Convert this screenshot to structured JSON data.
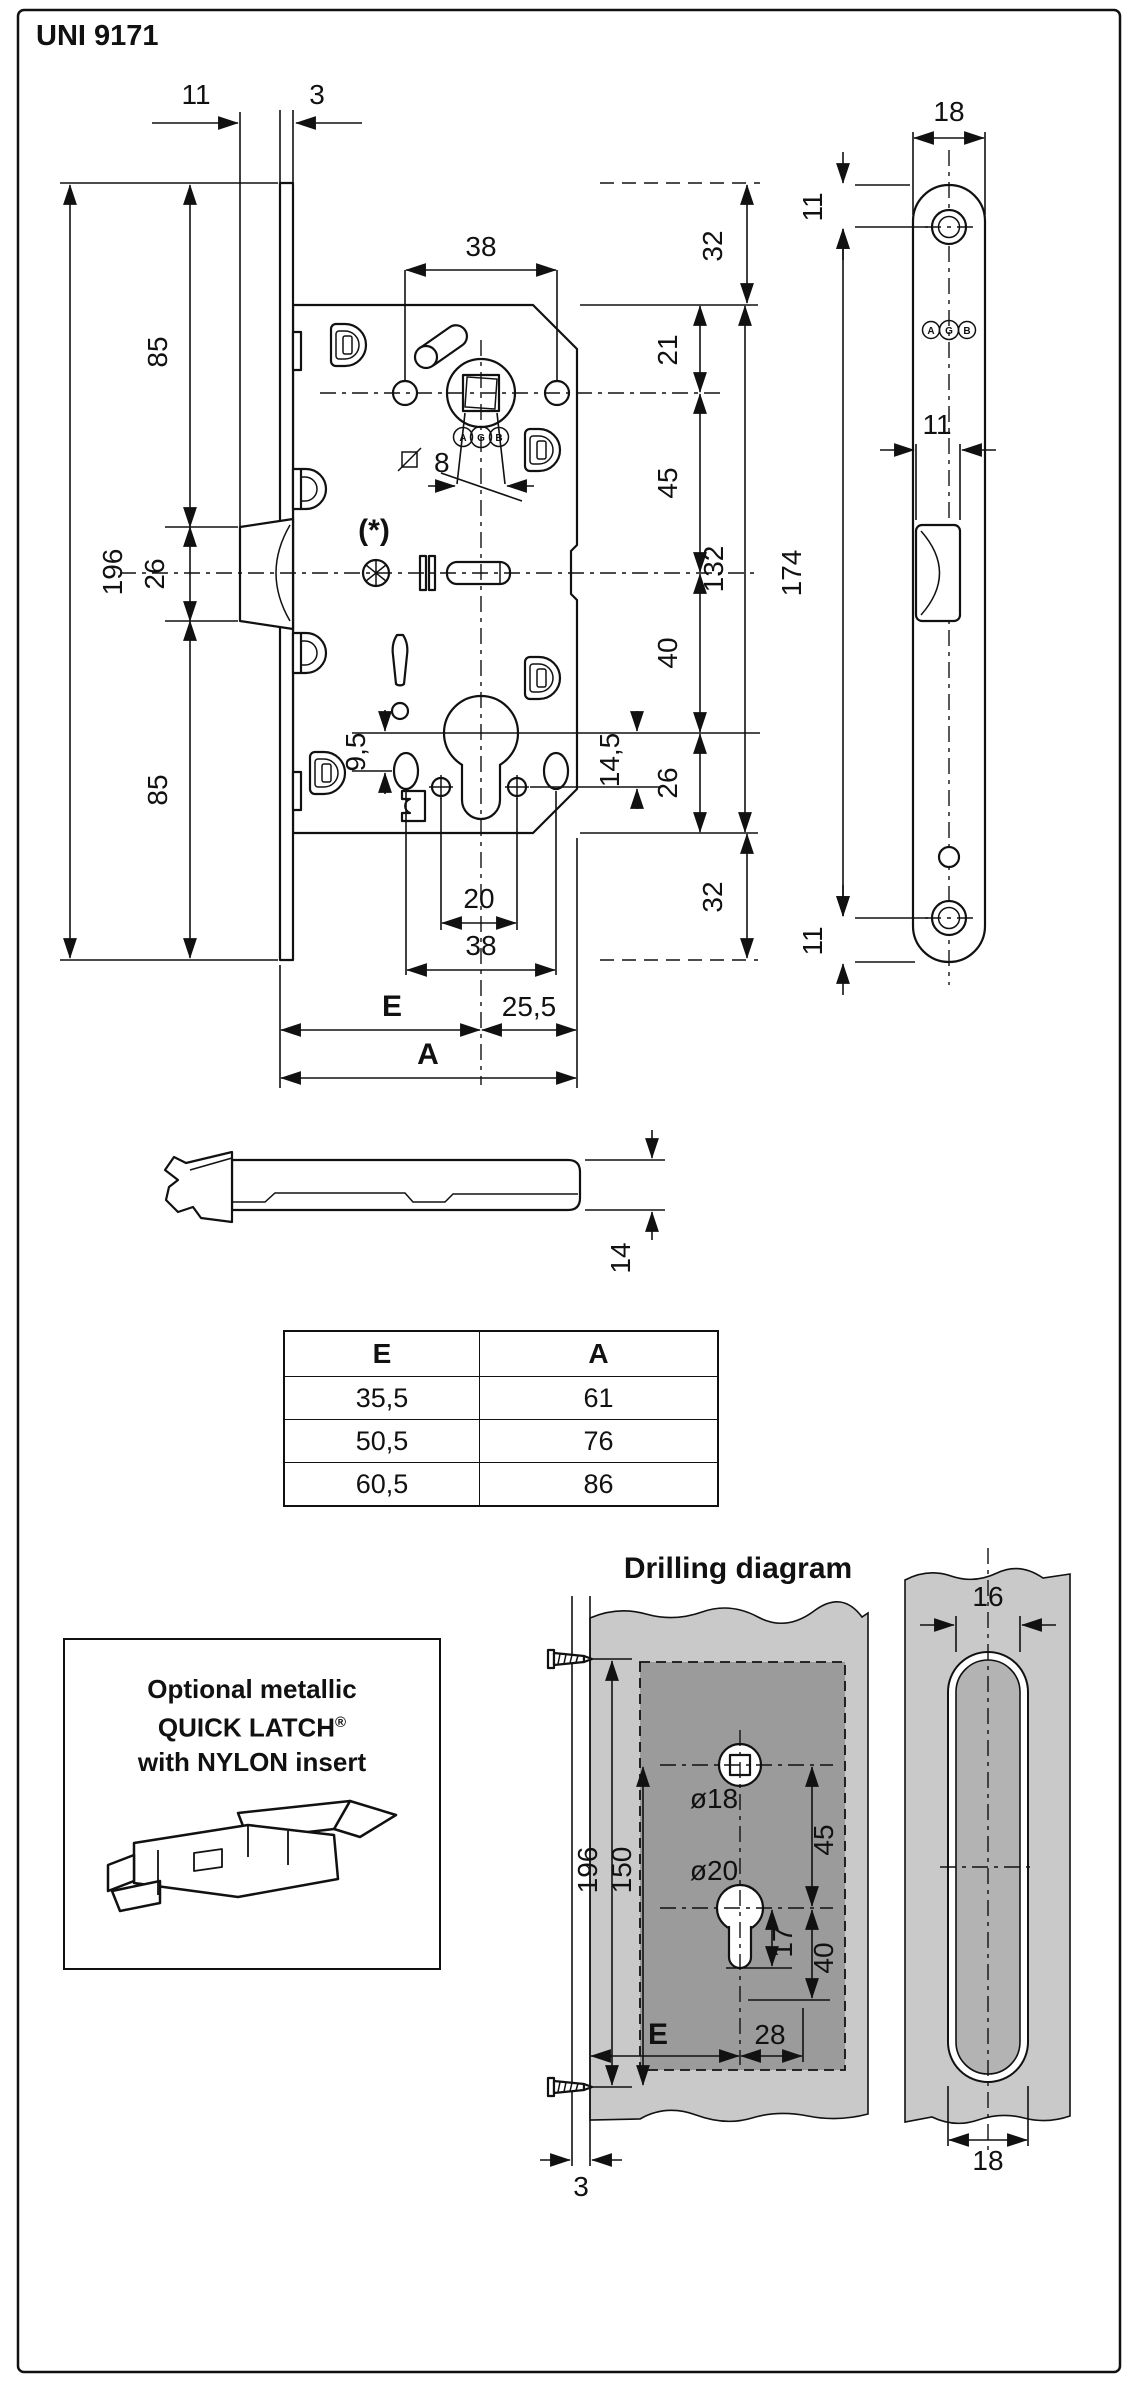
{
  "title": "UNI 9171",
  "lock": {
    "dim_latch_protrusion": "11",
    "dim_plate_thickness": "3",
    "dim_handle_spacing_top": "38",
    "dim_margin_top": "32",
    "dim_follower_from_top": "21",
    "dim_follower_to_latch": "45",
    "dim_latch_to_cylinder": "40",
    "dim_cylinder_to_bottom": "26",
    "dim_case_height": "132",
    "dim_margin_bottom": "32",
    "dim_plate_height": "196",
    "dim_plate_upper": "85",
    "dim_plate_latch": "26",
    "dim_plate_lower": "85",
    "spindle_size": "8",
    "variant_note": "(*)",
    "dim_cyl_offset_left": "9,5",
    "dim_cyl_offset_right": "14,5",
    "dim_fix_holes": "20",
    "dim_handle_spacing_bottom": "38",
    "backset_label": "E",
    "dim_center_to_edge": "25,5",
    "overall_label": "A",
    "logo": {
      "a": "A",
      "g": "G",
      "b": "B"
    }
  },
  "striker": {
    "dim_width": "18",
    "dim_hole_top": "11",
    "dim_latch_opening": "11",
    "dim_holes_span": "174",
    "dim_hole_bottom": "11"
  },
  "latch_bolt": {
    "dim_height": "14"
  },
  "table": {
    "headers": [
      "E",
      "A"
    ],
    "rows": [
      [
        "35,5",
        "61"
      ],
      [
        "50,5",
        "76"
      ],
      [
        "60,5",
        "86"
      ]
    ]
  },
  "drilling": {
    "heading": "Drilling diagram",
    "dim_screws": "196",
    "dim_handle_height": "150",
    "dia_spindle": "ø18",
    "dim_spindle_to_cyl": "45",
    "dia_cylinder": "ø20",
    "dim_cyl_chain": "40",
    "dim_keyway": "17",
    "backset_label": "E",
    "dim_28": "28",
    "dim_recess_depth": "3"
  },
  "edge": {
    "dim_inner": "16",
    "dim_outer": "18"
  },
  "quick_latch": {
    "line1": "Optional metallic",
    "brand": "QUICK LATCH",
    "reg": "®",
    "line3": "with NYLON insert"
  }
}
